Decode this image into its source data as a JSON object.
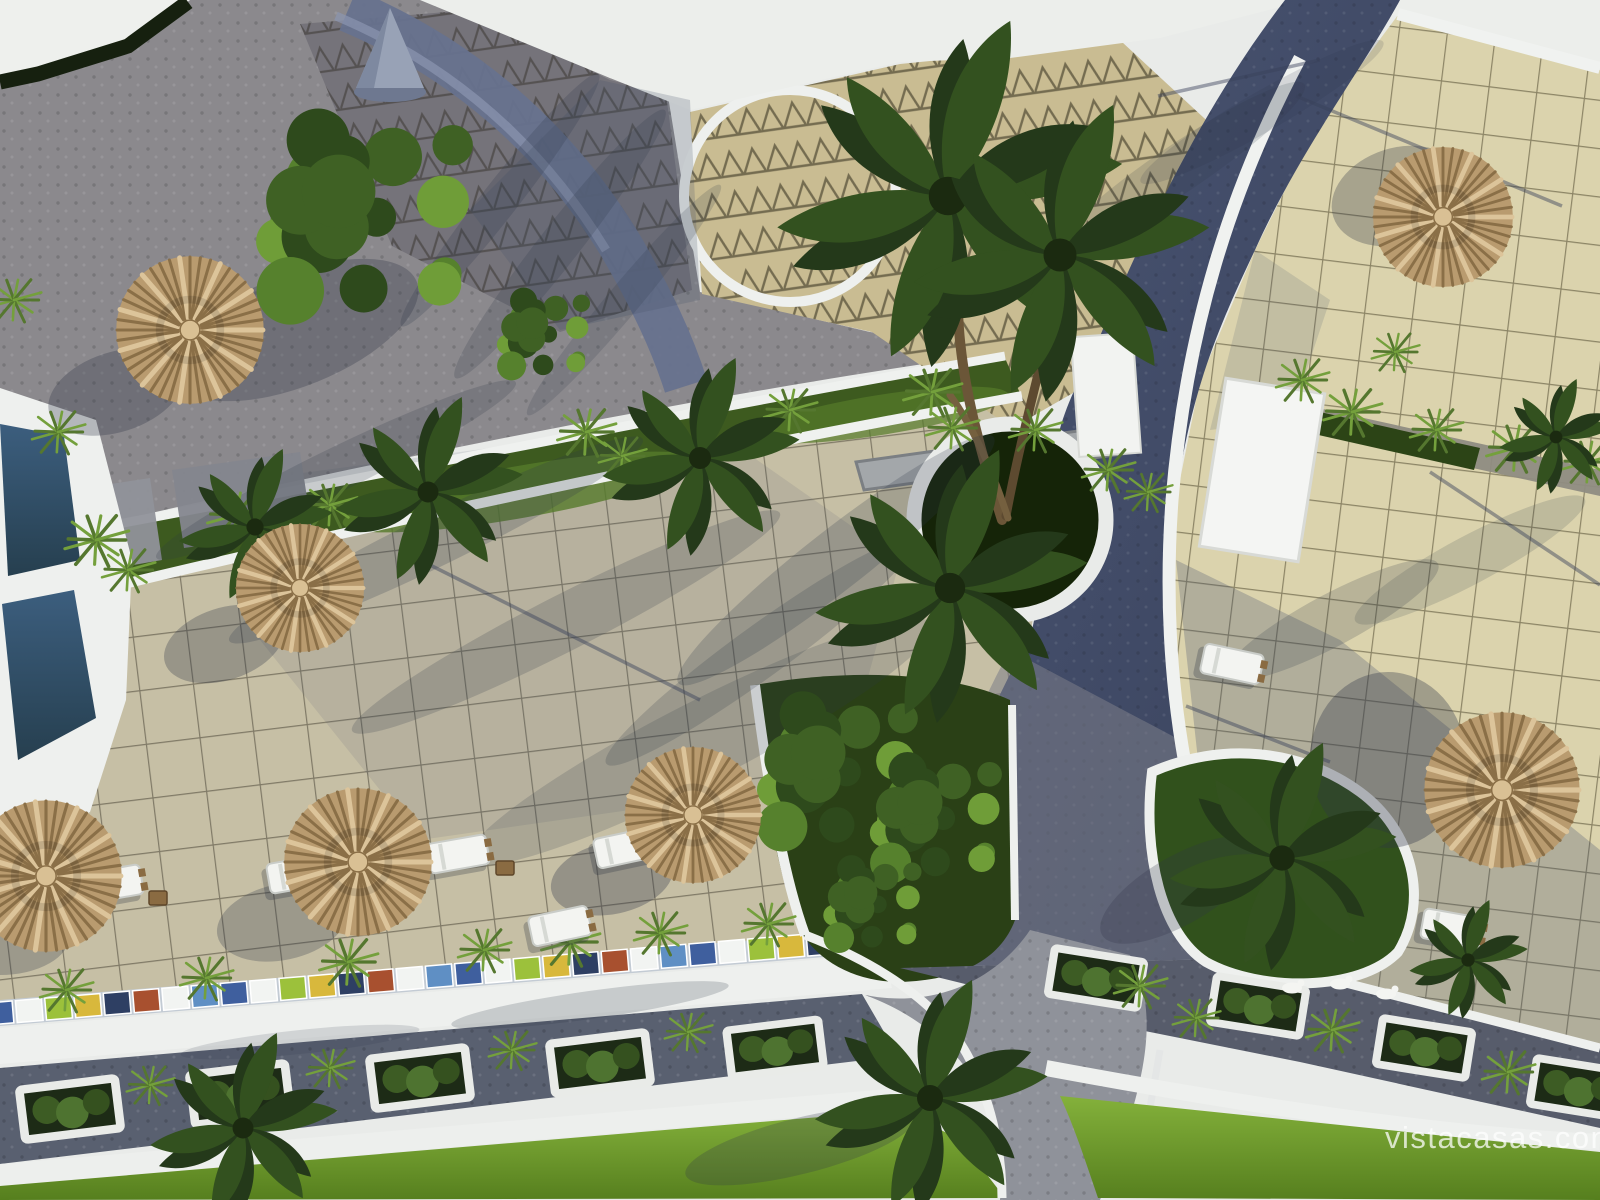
{
  "image": {
    "kind": "aerial-3d-architectural-render",
    "subject": "resort courtyard with pool, tiled sun terraces, straw parasols, palm trees, curved white walls and landscaped paths"
  },
  "watermark": {
    "text": "vistacasas.com"
  },
  "palette": {
    "roof_white": "#e9ebe9",
    "white_wall": "#eef0ee",
    "pebble_gray": "#8b898d",
    "shaded_paving": "#75737a",
    "triangle_tile_beige": "#c9bc92",
    "navy_path": "#424c6a",
    "left_terrace_tile": "#c6bfa5",
    "right_terrace_tile": "#dbd3ad",
    "tile_grout": "#5a5444",
    "garden_green": "#3d5a1f",
    "lawn_green": "#7cab35",
    "pool_water": "#2e4a63",
    "straw_umbrella": "#b99b6f",
    "dark_umbrella": "#42311f",
    "road_gray": "#8f929a",
    "watermark_white": "#ffffff"
  },
  "scene": {
    "umbrellas": [
      {
        "x": 190,
        "y": 330,
        "r": 76,
        "variant": "straw"
      },
      {
        "x": 300,
        "y": 588,
        "r": 66,
        "variant": "straw"
      },
      {
        "x": 46,
        "y": 876,
        "r": 78,
        "variant": "straw"
      },
      {
        "x": 358,
        "y": 862,
        "r": 76,
        "variant": "straw"
      },
      {
        "x": 693,
        "y": 815,
        "r": 70,
        "variant": "dark"
      },
      {
        "x": 1502,
        "y": 790,
        "r": 80,
        "variant": "dark"
      },
      {
        "x": 1443,
        "y": 217,
        "r": 72,
        "variant": "straw"
      }
    ],
    "loungers": [
      {
        "x": 112,
        "y": 884,
        "rot": -10
      },
      {
        "x": 298,
        "y": 874,
        "rot": -10
      },
      {
        "x": 458,
        "y": 854,
        "rot": -10
      },
      {
        "x": 560,
        "y": 926,
        "rot": -12
      },
      {
        "x": 625,
        "y": 848,
        "rot": -12
      },
      {
        "x": 1452,
        "y": 928,
        "rot": 10
      },
      {
        "x": 1232,
        "y": 664,
        "rot": 12
      }
    ],
    "side_tables": [
      {
        "x": 158,
        "y": 898
      },
      {
        "x": 348,
        "y": 888
      },
      {
        "x": 505,
        "y": 868
      }
    ],
    "planter_boxes": [
      {
        "x": 70,
        "y": 1109,
        "rot": -7,
        "w": 100,
        "h": 54
      },
      {
        "x": 240,
        "y": 1094,
        "rot": -7,
        "w": 100,
        "h": 54
      },
      {
        "x": 420,
        "y": 1078,
        "rot": -7,
        "w": 100,
        "h": 54
      },
      {
        "x": 600,
        "y": 1063,
        "rot": -7,
        "w": 100,
        "h": 54
      },
      {
        "x": 775,
        "y": 1048,
        "rot": -7,
        "w": 96,
        "h": 50
      },
      {
        "x": 1096,
        "y": 978,
        "rot": 9,
        "w": 94,
        "h": 50
      },
      {
        "x": 1258,
        "y": 1006,
        "rot": 9,
        "w": 94,
        "h": 50
      },
      {
        "x": 1424,
        "y": 1048,
        "rot": 9,
        "w": 94,
        "h": 50
      },
      {
        "x": 1578,
        "y": 1088,
        "rot": 9,
        "w": 94,
        "h": 50
      }
    ],
    "grass_tufts": [
      {
        "x": 14,
        "y": 300,
        "v": "pink",
        "s": 1
      },
      {
        "x": 58,
        "y": 432,
        "v": "pink",
        "s": 1
      },
      {
        "x": 96,
        "y": 540,
        "v": "pink",
        "s": 1.2
      },
      {
        "x": 128,
        "y": 570,
        "v": "green",
        "s": 1
      },
      {
        "x": 236,
        "y": 515,
        "v": "green",
        "s": 1.1
      },
      {
        "x": 330,
        "y": 505,
        "v": "green",
        "s": 1
      },
      {
        "x": 586,
        "y": 432,
        "v": "green",
        "s": 1.1
      },
      {
        "x": 622,
        "y": 456,
        "v": "pink",
        "s": 0.9
      },
      {
        "x": 790,
        "y": 410,
        "v": "green",
        "s": 1
      },
      {
        "x": 932,
        "y": 392,
        "v": "green",
        "s": 1.1
      },
      {
        "x": 1035,
        "y": 430,
        "v": "green",
        "s": 1
      },
      {
        "x": 1108,
        "y": 470,
        "v": "green",
        "s": 1
      },
      {
        "x": 1148,
        "y": 492,
        "v": "pink",
        "s": 0.9
      },
      {
        "x": 1302,
        "y": 380,
        "v": "pink",
        "s": 1
      },
      {
        "x": 1352,
        "y": 412,
        "v": "green",
        "s": 1.1
      },
      {
        "x": 1436,
        "y": 430,
        "v": "green",
        "s": 1
      },
      {
        "x": 1515,
        "y": 448,
        "v": "green",
        "s": 1.1
      },
      {
        "x": 1588,
        "y": 462,
        "v": "green",
        "s": 1
      },
      {
        "x": 1395,
        "y": 352,
        "v": "pink",
        "s": 0.9
      },
      {
        "x": 66,
        "y": 990,
        "v": "pink",
        "s": 1
      },
      {
        "x": 206,
        "y": 978,
        "v": "pink",
        "s": 1
      },
      {
        "x": 348,
        "y": 962,
        "v": "pink",
        "s": 1.1
      },
      {
        "x": 484,
        "y": 950,
        "v": "pink",
        "s": 1
      },
      {
        "x": 570,
        "y": 942,
        "v": "pink",
        "s": 1.1
      },
      {
        "x": 660,
        "y": 933,
        "v": "pink",
        "s": 1
      },
      {
        "x": 768,
        "y": 924,
        "v": "pink",
        "s": 1
      },
      {
        "x": 150,
        "y": 1085,
        "v": "pink",
        "s": 0.9
      },
      {
        "x": 330,
        "y": 1068,
        "v": "pink",
        "s": 0.9
      },
      {
        "x": 512,
        "y": 1050,
        "v": "pink",
        "s": 0.9
      },
      {
        "x": 688,
        "y": 1032,
        "v": "pink",
        "s": 0.9
      },
      {
        "x": 1140,
        "y": 986,
        "v": "dry",
        "s": 1
      },
      {
        "x": 1196,
        "y": 1018,
        "v": "dry",
        "s": 0.9
      },
      {
        "x": 1332,
        "y": 1030,
        "v": "dry",
        "s": 1
      },
      {
        "x": 1508,
        "y": 1072,
        "v": "dry",
        "s": 1
      },
      {
        "x": 952,
        "y": 428,
        "v": "green",
        "s": 1
      }
    ],
    "palms": [
      {
        "x": 948,
        "y": 196,
        "r": 175,
        "variant": "dark"
      },
      {
        "x": 1060,
        "y": 255,
        "r": 150,
        "variant": "dark"
      },
      {
        "x": 950,
        "y": 588,
        "r": 138,
        "variant": "fern"
      },
      {
        "x": 428,
        "y": 492,
        "r": 95,
        "variant": "fern"
      },
      {
        "x": 700,
        "y": 458,
        "r": 100,
        "variant": "fern"
      },
      {
        "x": 255,
        "y": 527,
        "r": 78,
        "variant": "fern"
      },
      {
        "x": 1282,
        "y": 858,
        "r": 115,
        "variant": "light"
      },
      {
        "x": 930,
        "y": 1098,
        "r": 118,
        "variant": "light"
      },
      {
        "x": 243,
        "y": 1128,
        "r": 95,
        "variant": "light"
      },
      {
        "x": 1556,
        "y": 437,
        "r": 58,
        "variant": "fern"
      },
      {
        "x": 1468,
        "y": 960,
        "r": 60,
        "variant": "fern"
      }
    ],
    "bushes": [
      {
        "x": 368,
        "y": 212,
        "r": 128
      },
      {
        "x": 545,
        "y": 332,
        "r": 55
      },
      {
        "x": 840,
        "y": 768,
        "r": 95
      },
      {
        "x": 938,
        "y": 815,
        "r": 78
      },
      {
        "x": 874,
        "y": 902,
        "r": 58
      }
    ],
    "shadows": [
      {
        "x": 116,
        "y": 392,
        "rx": 70,
        "ry": 40,
        "rot": -18,
        "o": 0.3
      },
      {
        "x": 224,
        "y": 644,
        "rx": 62,
        "ry": 36,
        "rot": -18,
        "o": 0.3
      },
      {
        "x": 282,
        "y": 922,
        "rx": 66,
        "ry": 38,
        "rot": -12,
        "o": 0.28
      },
      {
        "x": 0,
        "y": 935,
        "rx": 70,
        "ry": 40,
        "rot": 0,
        "o": 0.28
      },
      {
        "x": 612,
        "y": 878,
        "rx": 62,
        "ry": 36,
        "rot": -12,
        "o": 0.32
      },
      {
        "x": 1388,
        "y": 760,
        "rx": 78,
        "ry": 88,
        "rot": 0,
        "o": 0.34
      },
      {
        "x": 1398,
        "y": 196,
        "rx": 68,
        "ry": 48,
        "rot": -18,
        "o": 0.3
      },
      {
        "x": 296,
        "y": 330,
        "rx": 130,
        "ry": 56,
        "rot": -22,
        "o": 0.3
      },
      {
        "x": 500,
        "y": 200,
        "rx": 160,
        "ry": 18,
        "rot": -52,
        "o": 0.22
      },
      {
        "x": 560,
        "y": 244,
        "rx": 170,
        "ry": 20,
        "rot": -52,
        "o": 0.2
      },
      {
        "x": 624,
        "y": 300,
        "rx": 150,
        "ry": 16,
        "rot": -50,
        "o": 0.18
      },
      {
        "x": 336,
        "y": 470,
        "rx": 200,
        "ry": 22,
        "rot": -26,
        "o": 0.2
      },
      {
        "x": 436,
        "y": 540,
        "rx": 230,
        "ry": 26,
        "rot": -26,
        "o": 0.22
      },
      {
        "x": 566,
        "y": 622,
        "rx": 240,
        "ry": 28,
        "rot": -27,
        "o": 0.2
      },
      {
        "x": 700,
        "y": 742,
        "rx": 260,
        "ry": 40,
        "rot": -27,
        "o": 0.18
      },
      {
        "x": 836,
        "y": 560,
        "rx": 200,
        "ry": 30,
        "rot": -38,
        "o": 0.22
      },
      {
        "x": 760,
        "y": 652,
        "rx": 190,
        "ry": 26,
        "rot": -36,
        "o": 0.2
      },
      {
        "x": 1180,
        "y": 168,
        "rx": 150,
        "ry": 24,
        "rot": -34,
        "o": 0.16
      },
      {
        "x": 1262,
        "y": 112,
        "rx": 140,
        "ry": 20,
        "rot": -30,
        "o": 0.14
      },
      {
        "x": 800,
        "y": 1146,
        "rx": 118,
        "ry": 28,
        "rot": -14,
        "o": 0.25
      },
      {
        "x": 1180,
        "y": 890,
        "rx": 90,
        "ry": 34,
        "rot": -30,
        "o": 0.25
      },
      {
        "x": 1332,
        "y": 620,
        "rx": 120,
        "ry": 26,
        "rot": -28,
        "o": 0.2
      },
      {
        "x": 1470,
        "y": 560,
        "rx": 130,
        "ry": 24,
        "rot": -28,
        "o": 0.16
      },
      {
        "x": 590,
        "y": 1005,
        "rx": 140,
        "ry": 14,
        "rot": -8,
        "o": 0.2
      },
      {
        "x": 300,
        "y": 1042,
        "rx": 120,
        "ry": 12,
        "rot": -6,
        "o": 0.15
      }
    ],
    "shadow_lines": [
      {
        "x1": 1296,
        "y1": 96,
        "x2": 1562,
        "y2": 206
      },
      {
        "x1": 1158,
        "y1": 96,
        "x2": 1320,
        "y2": 60
      },
      {
        "x1": 1430,
        "y1": 472,
        "x2": 1600,
        "y2": 585
      },
      {
        "x1": 1186,
        "y1": 706,
        "x2": 1330,
        "y2": 762
      },
      {
        "x1": 420,
        "y1": 560,
        "x2": 700,
        "y2": 700
      }
    ],
    "mosaic_border": {
      "x1": 0,
      "y1": 1013,
      "x2": 820,
      "y2": 944,
      "height": 22,
      "colors": [
        "#3f5f9e",
        "#f2f4f2",
        "#9cc13b",
        "#d8b83c",
        "#2e3f63",
        "#a8502f",
        "#f2f4f2",
        "#5f8fc4"
      ]
    },
    "animals": [
      {
        "x": 1292,
        "y": 988
      },
      {
        "x": 1340,
        "y": 984
      },
      {
        "x": 1386,
        "y": 994
      }
    ]
  }
}
